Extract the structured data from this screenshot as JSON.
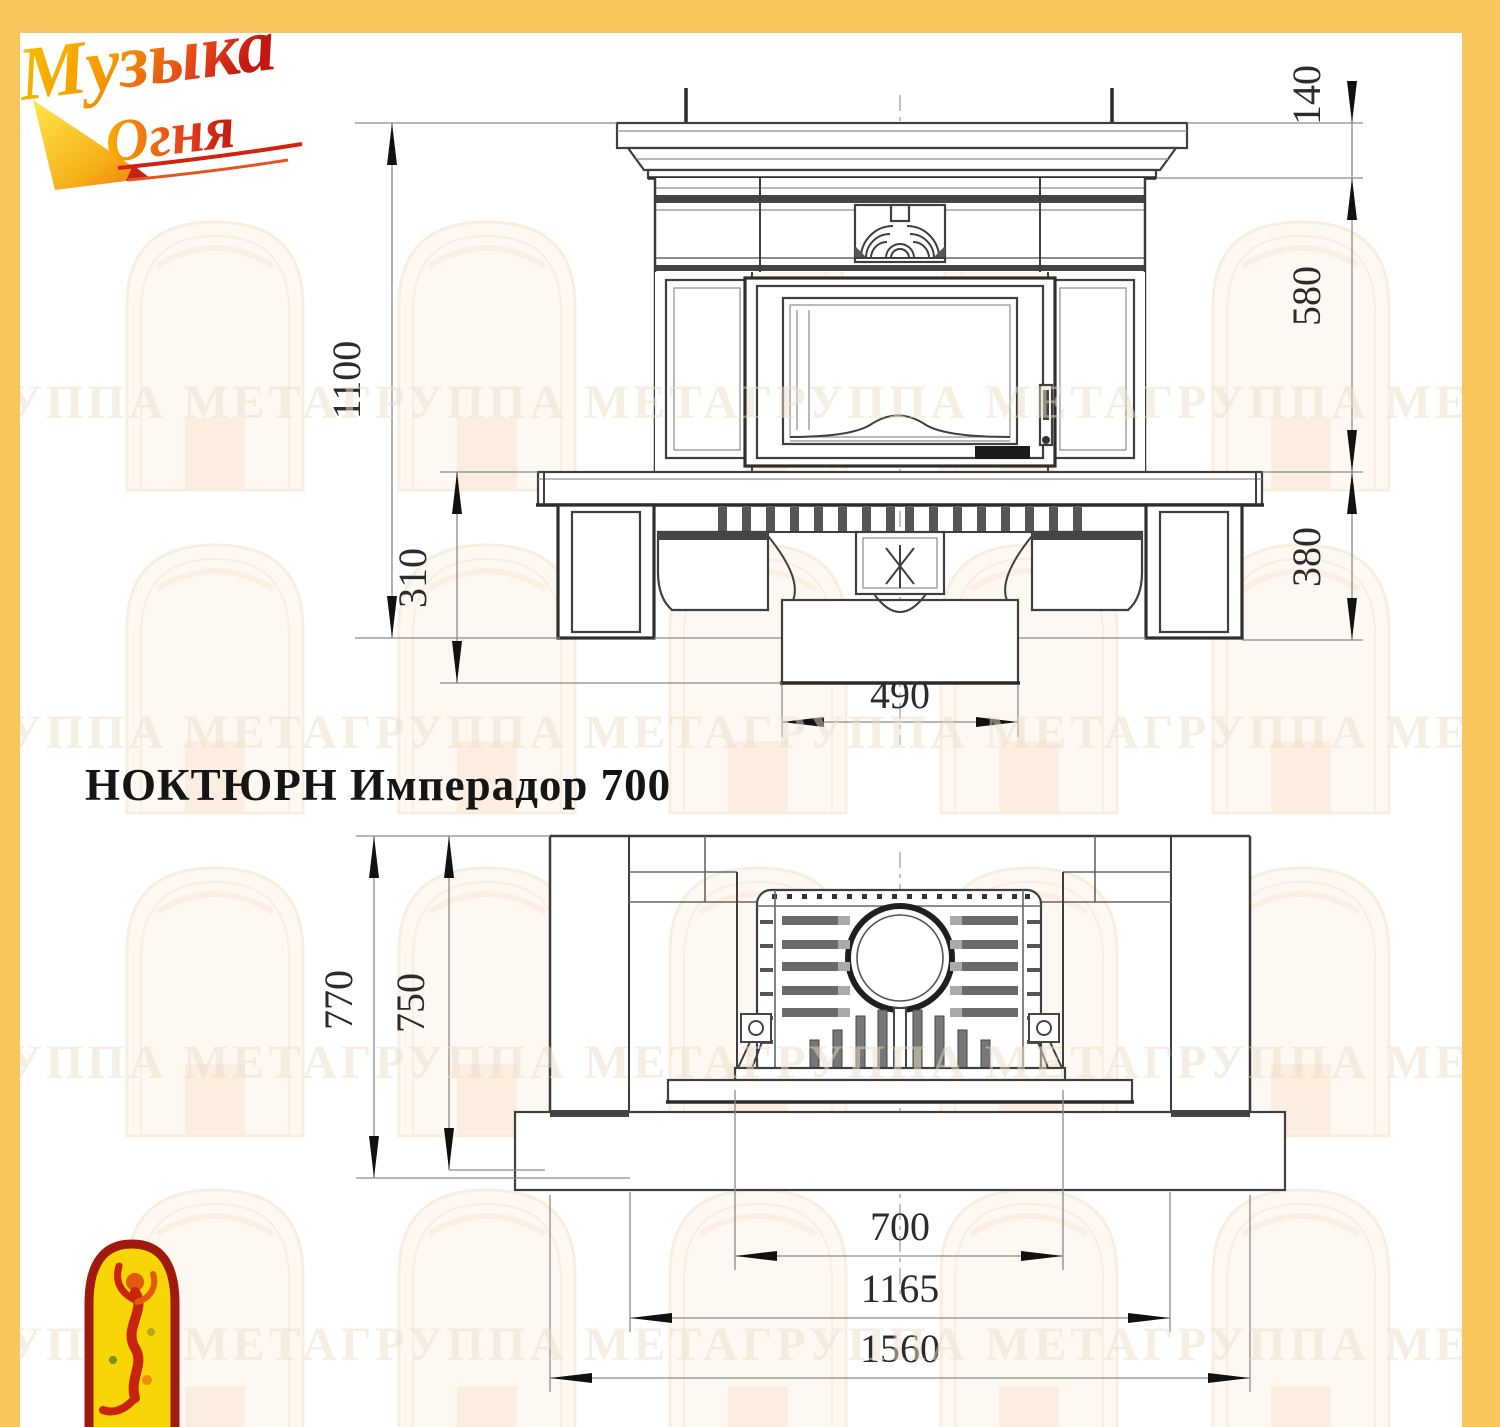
{
  "title": "НОКТЮРН Имперадор 700",
  "logo": {
    "word1": "Музыка",
    "word2": "Огня"
  },
  "icons": {
    "corner_logo": "flame-arch-icon",
    "brand_logo": "music-of-fire-logo"
  },
  "watermark": {
    "phrase": "ГРУППА МЕТА"
  },
  "front_view": {
    "dims": {
      "total_height": "1100",
      "plinth_height": "310",
      "shelf_height": "140",
      "middle_height": "580",
      "base_height": "380",
      "base_width": "490"
    }
  },
  "plan_view": {
    "dims": {
      "total_depth": "770",
      "inner_depth": "750",
      "firebox_width": "700",
      "inner_width": "1165",
      "total_width": "1560"
    }
  },
  "colors": {
    "border_yellow": "#f7c75e",
    "line_dark": "#3f3f3f",
    "dim_text": "#2b2b2b"
  }
}
